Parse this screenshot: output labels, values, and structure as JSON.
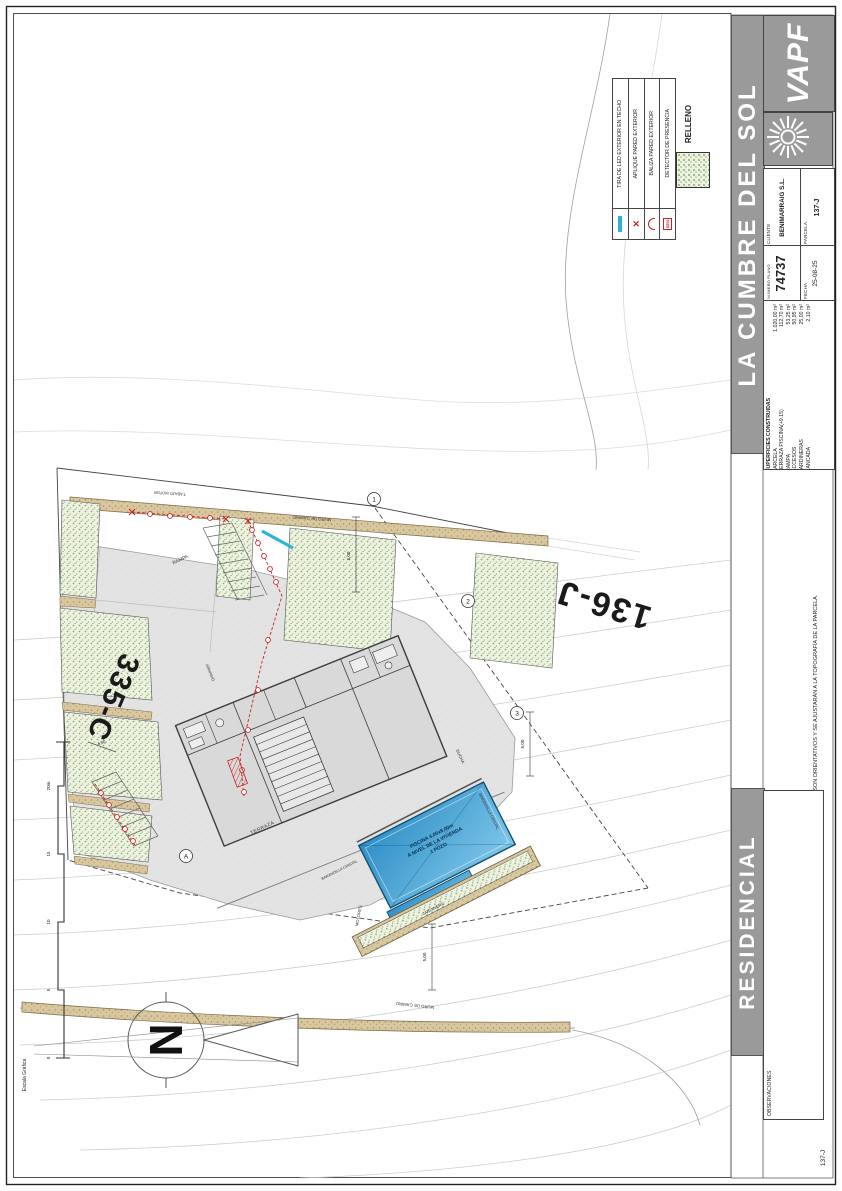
{
  "legend": {
    "items": [
      {
        "label": "TIRA DE LED EXTERIOR EN TECHO"
      },
      {
        "label": "APLIQUE PARED EXTERIOR"
      },
      {
        "label": "BALIZA PARED EXTERIOR"
      },
      {
        "label": "DETECTOR DE PRESENCIA",
        "symbol_text": "SEN"
      }
    ],
    "relleno_label": "RELLENO",
    "led_color": "#2ab5d8",
    "marker_color": "#cc2222",
    "relleno_color": "#edf2e2"
  },
  "plan": {
    "parcel_label_right": "136-J",
    "parcel_label_left": "335-C",
    "labels": {
      "muro_top": "MURO DE CAMINO",
      "muro_bottom": "MURO DE CAMINO",
      "t_abajo": "T.ABAJO MOTOR",
      "rampa": "RAMPA",
      "terraza": "TERRAZA",
      "ducha": "DUCHA",
      "armario": "ARMARIO",
      "motores": "MOTORES",
      "jardinera": "JARDINERA",
      "barandilla_1": "BARANDILLA CRISTAL",
      "barandilla_2": "BARANDILLA CRISTAL"
    },
    "pool": {
      "line1": "PISCINA 4,00x8,00m",
      "line2": "A NIVEL DE LA VIVIENDA",
      "line3": "1 POZO",
      "water_color": "#2f8fc6"
    },
    "dimensions": {
      "d1": "5,00",
      "d2": "5,00",
      "d3": "5,00",
      "d4": "4,00"
    },
    "refs": {
      "r1": "1",
      "r2": "2",
      "r3": "3",
      "ra": "A"
    },
    "north_letter": "N",
    "scalebar": {
      "title": "Escala Gráfica",
      "t20": "20m",
      "t15": "15",
      "t10": "10",
      "t5": "5",
      "t0": "0"
    }
  },
  "titleblock": {
    "brand": "VAPF",
    "development": "LA CUMBRE DEL SOL",
    "residential": "RESIDENCIAL JAZMINES",
    "cliente_label": "CLIENTE",
    "cliente": "BENIMARRAIG S.L.",
    "parcela_label": "PARCELA",
    "parcela": "137-J",
    "numero_plano_label": "NUMERO PLANO",
    "numero_plano": "74737",
    "fecha_label": "FECHA",
    "fecha": "25-08-25",
    "superficies": {
      "title": "SUPERFICIES CONSTRUIDAS",
      "rows": [
        [
          "PARCELA",
          "1.020,00 m²"
        ],
        [
          "TERRAZA PISCINA(+9.15)",
          "112,70 m²"
        ],
        [
          "RAMPA",
          "53,25 m²"
        ],
        [
          "ACCESOS",
          "50,95 m²"
        ],
        [
          "JARDINERAS",
          "25,00 m²"
        ],
        [
          "BANCADA",
          "2,10 m²"
        ]
      ]
    },
    "nota": "LOS NIVELES SON ORIENTATIVOS Y SE AJUSTARÁN A LA TOPOGRAFÍA DE LA PARCELA.",
    "observaciones_label": "OBSERVACIONES",
    "sheet_corner": "137-J",
    "band_color": "#9a9a9a"
  }
}
